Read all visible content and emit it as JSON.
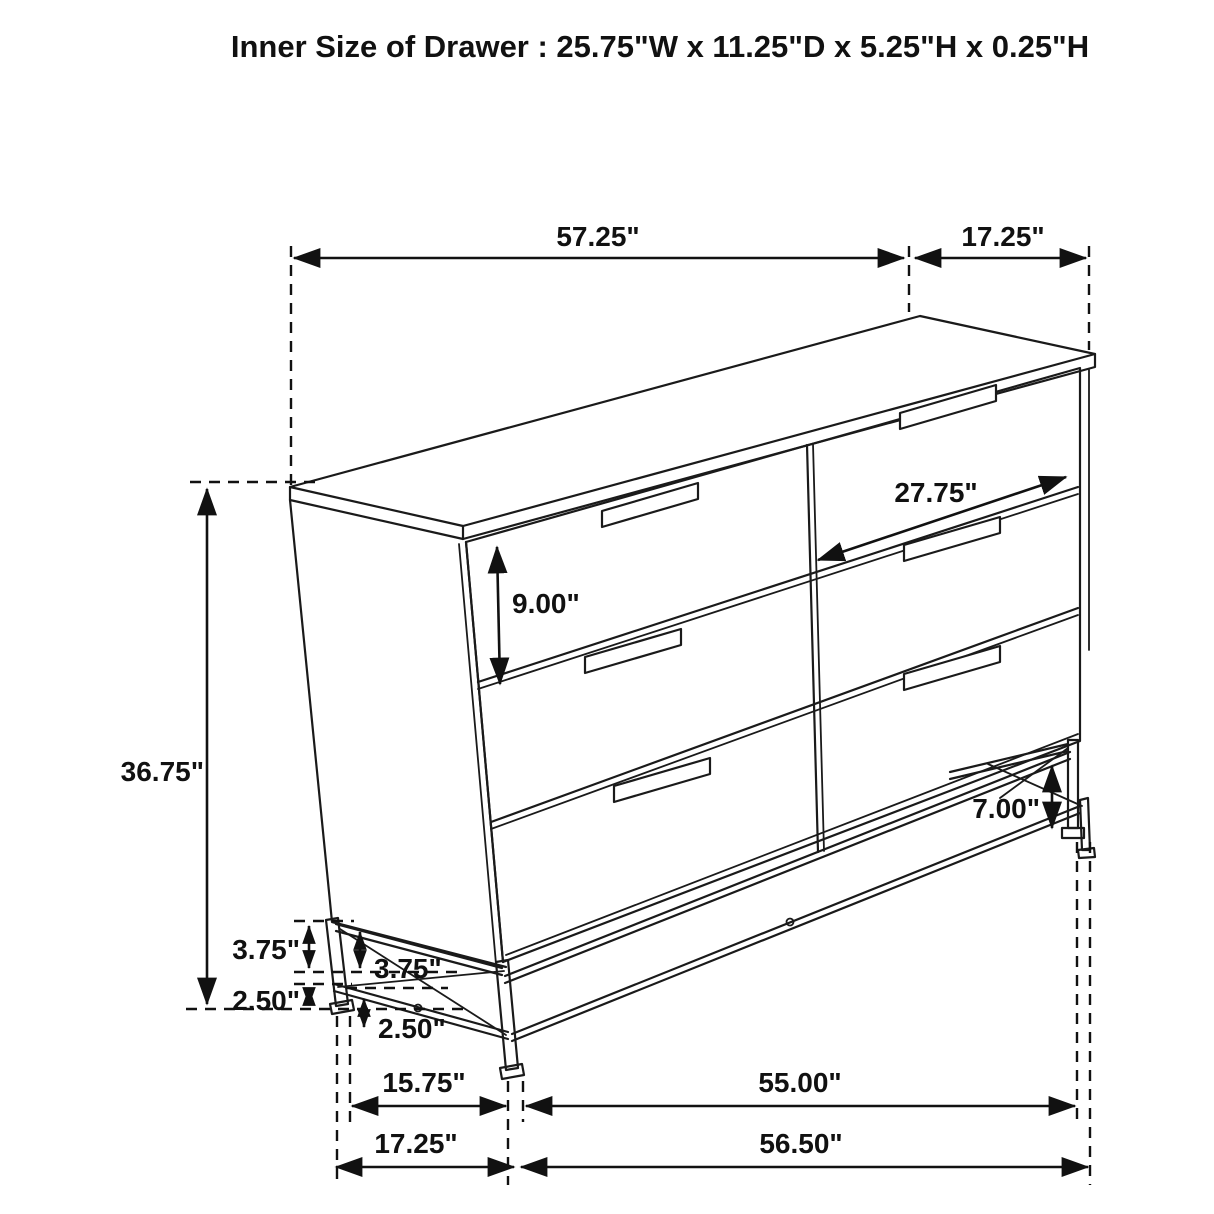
{
  "title": "Inner Size of Drawer : 25.75\"W x 11.25\"D x 5.25\"H x 0.25\"H",
  "figure": {
    "subject": "six-drawer dresser",
    "style": "black-and-white isometric dimension line drawing",
    "drawer_layout": "2 columns x 3 rows"
  },
  "colors": {
    "background": "#ffffff",
    "line": "#1a1a1a",
    "text": "#111111"
  },
  "dims": {
    "top_width": "57.25\"",
    "top_depth": "17.25\"",
    "drawer_width": "27.75\"",
    "drawer_front_height": "9.00\"",
    "overall_height": "36.75\"",
    "base_upper_rear": "3.75\"",
    "base_lower_rear": "2.50\"",
    "base_upper_front": "3.75\"",
    "base_lower_front": "2.50\"",
    "base_leg_height": "7.00\"",
    "base_depth_inner": "15.75\"",
    "base_width_inner": "55.00\"",
    "base_depth_outer": "17.25\"",
    "base_width_outer": "56.50\""
  }
}
